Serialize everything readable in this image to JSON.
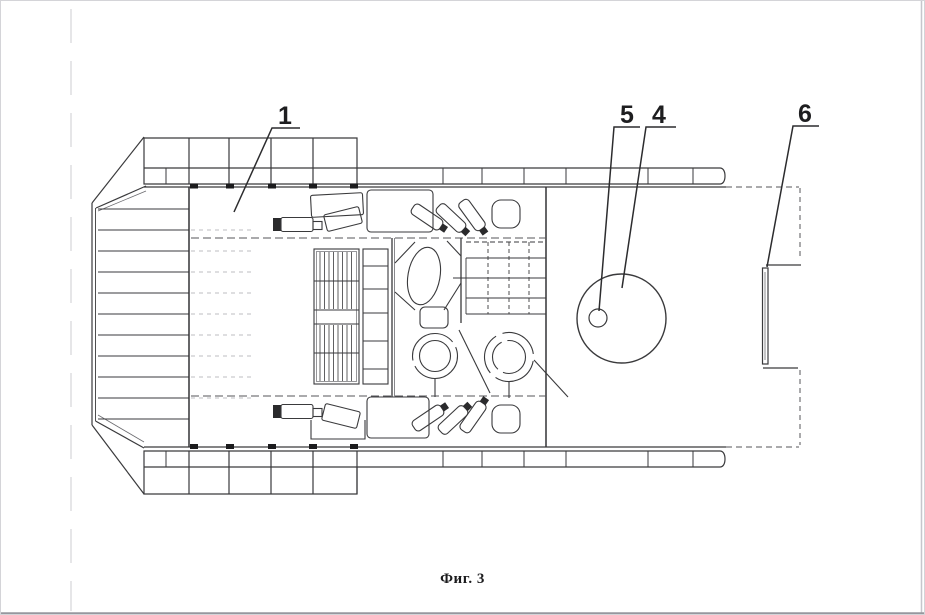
{
  "figure": {
    "caption": "Фиг. 3"
  },
  "callouts": [
    {
      "label": "1"
    },
    {
      "label": "5"
    },
    {
      "label": "4"
    },
    {
      "label": "6"
    }
  ],
  "colors": {
    "background": "#ffffff",
    "line": "#3a3a3c",
    "light_line": "#8a8a8e",
    "text": "#1b1b1d",
    "page_edge": "#97979e"
  }
}
